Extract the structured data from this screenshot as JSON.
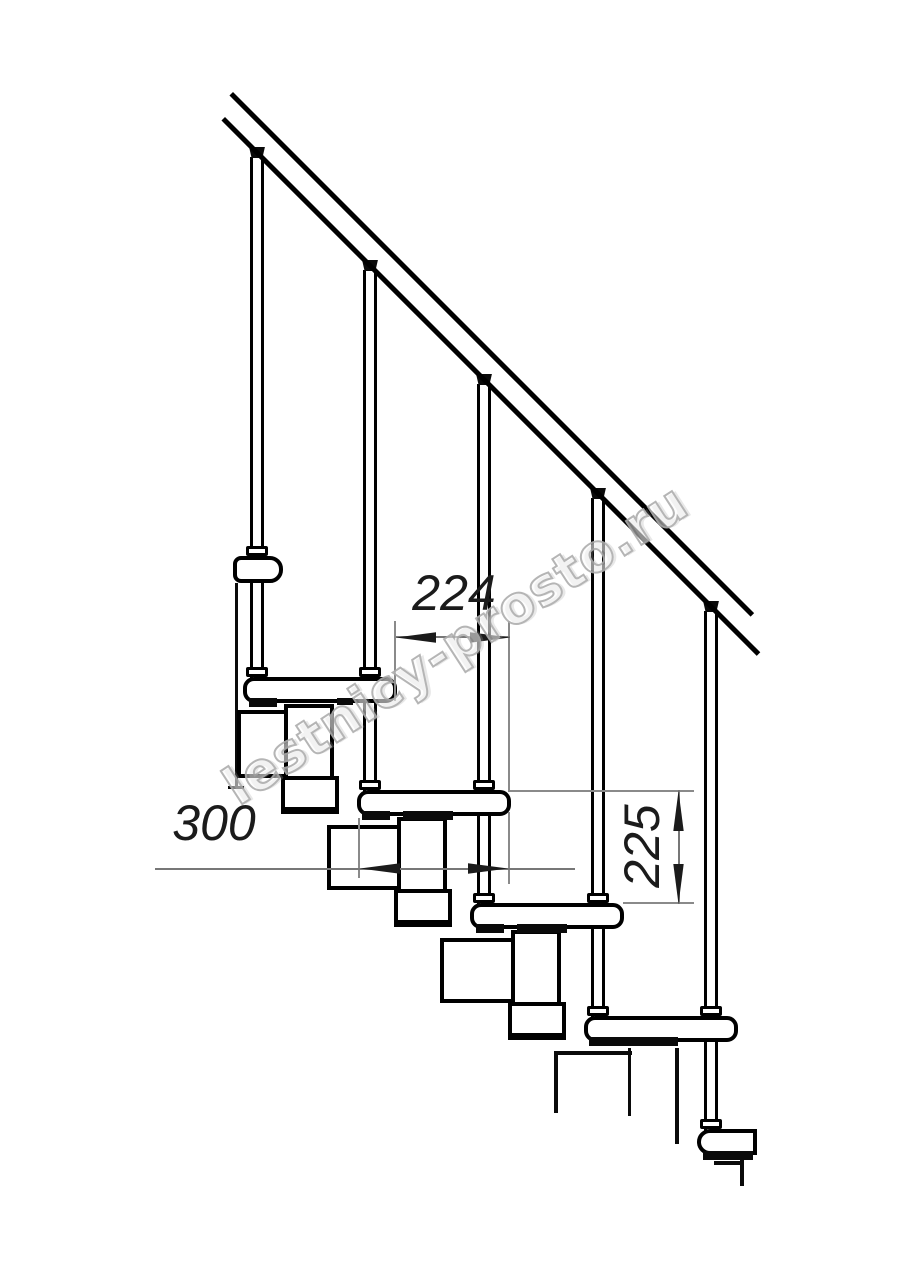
{
  "drawing": {
    "title_label": "Modular staircase side elevation",
    "watermark": "lestnicy-prosto.ru",
    "dimensions": {
      "run_between_steps": "224",
      "tread_depth": "300",
      "rise_between_steps": "225"
    },
    "colors": {
      "line": "#000000",
      "dimension_line": "#8a8a8a",
      "dimension_text": "#1b1b1b",
      "background": "#ffffff",
      "watermark_outline": "#aeaeae"
    }
  }
}
